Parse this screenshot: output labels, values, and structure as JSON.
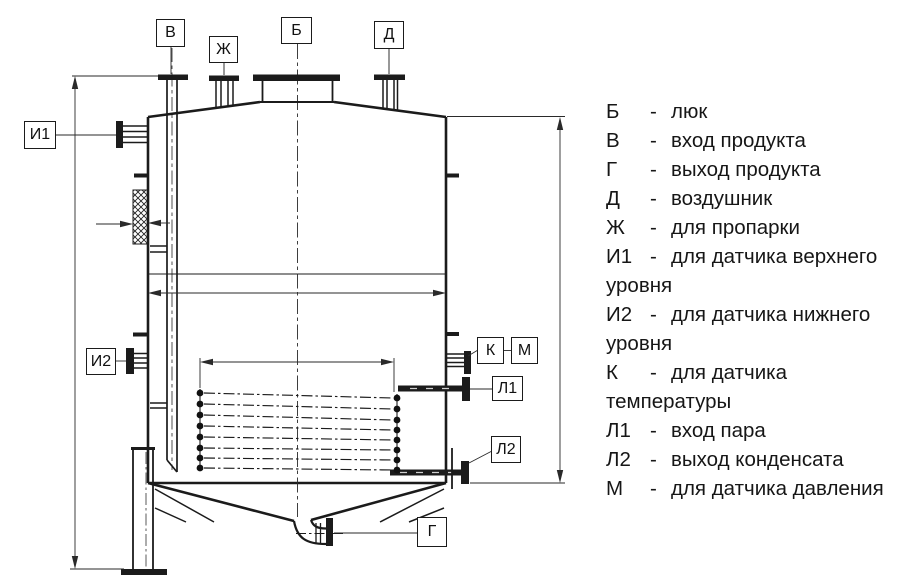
{
  "drawing": {
    "callouts": {
      "b": "Б",
      "v": "В",
      "zh": "Ж",
      "d": "Д",
      "i1": "И1",
      "i2": "И2",
      "k": "К",
      "m": "М",
      "l1": "Л1",
      "l2": "Л2",
      "g": "Г"
    },
    "line_color": "#1b1b1b"
  },
  "legend": {
    "entries": [
      {
        "key": "Б",
        "sep": "-",
        "text": "люк"
      },
      {
        "key": "В",
        "sep": "-",
        "text": "вход продукта"
      },
      {
        "key": "Г",
        "sep": "-",
        "text": "выход продукта"
      },
      {
        "key": "Д",
        "sep": "-",
        "text": "воздушник"
      },
      {
        "key": "Ж",
        "sep": "-",
        "text": "для пропарки"
      },
      {
        "key": "И1",
        "sep": "-",
        "text": "для датчика верхнего"
      },
      {
        "text": "уровня"
      },
      {
        "key": "И2",
        "sep": "-",
        "text": "для датчика нижнего"
      },
      {
        "text": "уровня"
      },
      {
        "key": "К",
        "sep": "-",
        "text": "для датчика"
      },
      {
        "text": "температуры"
      },
      {
        "key": "Л1",
        "sep": "-",
        "text": "вход пара"
      },
      {
        "key": "Л2",
        "sep": "-",
        "text": "выход конденсата"
      },
      {
        "key": "М",
        "sep": "-",
        "text": "для датчика давления"
      }
    ]
  }
}
